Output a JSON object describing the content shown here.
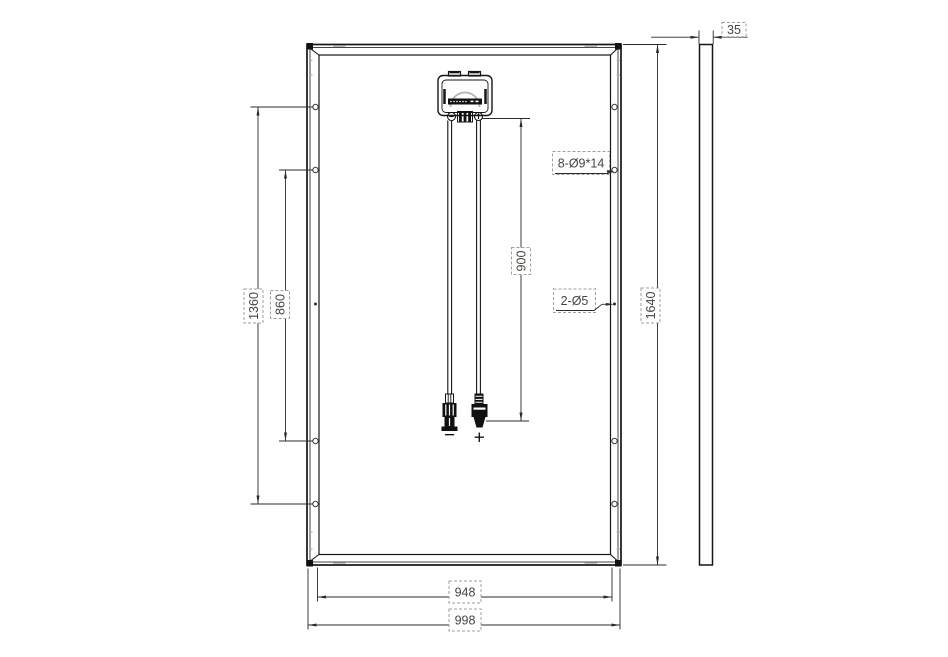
{
  "diagram": {
    "type": "solar-panel-rear-view-technical-drawing",
    "labels": {
      "outer_height": "1640",
      "outer_width": "998",
      "inner_width": "948",
      "hole_span_outer": "1360",
      "hole_span_inner": "860",
      "cable_length": "900",
      "panel_thickness": "35",
      "mounting_holes_note": "8-Ø9*14",
      "grounding_holes_note": "2-Ø5",
      "negative_sign": "−",
      "positive_sign": "+"
    },
    "dimensions_mm": {
      "outer_height": 1640,
      "outer_width": 998,
      "inner_width": 948,
      "hole_span_outer": 1360,
      "hole_span_inner": 860,
      "cable_length": 900,
      "panel_thickness": 35,
      "mounting_holes_count": 8,
      "mounting_hole_size": "9x14",
      "grounding_holes_count": 2,
      "grounding_hole_diameter": 5
    },
    "colors": {
      "line": "#161616",
      "dimension_line": "#2b2b2b",
      "text": "#4a453e",
      "dashed_box": "#9f9f9f",
      "dome_arc": "#b3b3b3"
    }
  }
}
